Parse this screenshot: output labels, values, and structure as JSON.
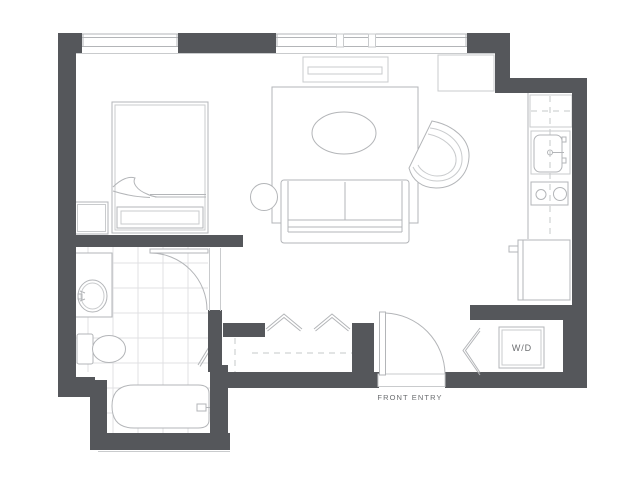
{
  "document": {
    "type": "floor-plan"
  },
  "labels": {
    "washer_dryer": "W/D",
    "front_entry": "FRONT ENTRY"
  },
  "colors": {
    "wall": "#55575b",
    "fixture_line": "#b3b5b8",
    "light_line": "#c9cbcd",
    "tile_line": "#e0e1e3",
    "label_text": "#6b6d70",
    "background": "#ffffff"
  },
  "fixtures": [
    "bed",
    "nightstand",
    "bedroom-windows",
    "tv-console",
    "area-rug",
    "coffee-table",
    "side-table",
    "sofa",
    "armchair",
    "upper-cabinet",
    "refrigerator",
    "kitchen-sink",
    "cooktop",
    "kitchen-counter",
    "bathroom-vanity",
    "vanity-sink",
    "toilet",
    "bathtub",
    "bathroom-tile-floor",
    "bathroom-door",
    "linen-closet-door",
    "entry-closet-bifold-doors",
    "washer-dryer-closet",
    "washer-dryer-bifold-door",
    "front-door",
    "entry-threshold"
  ]
}
